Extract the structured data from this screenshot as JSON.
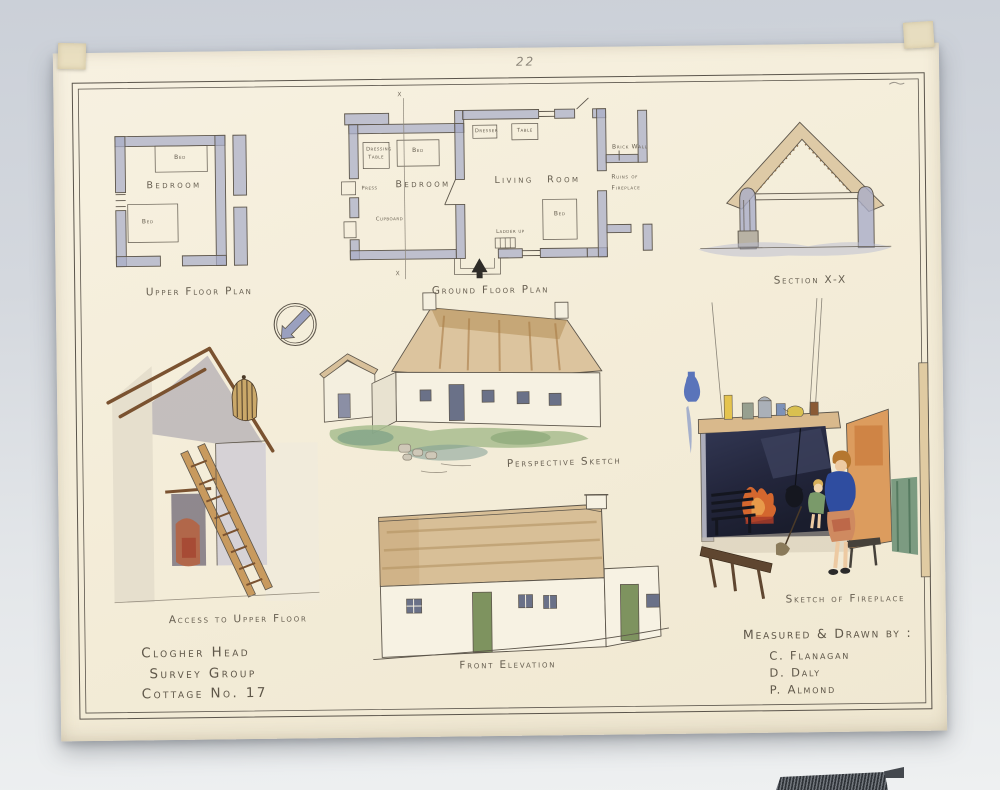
{
  "sheet": {
    "page_number": "22",
    "title_block": {
      "line1": "Clogher Head",
      "line2": "Survey Group",
      "line3": "Cottage No. 17"
    },
    "credits": {
      "heading": "Measured & Drawn by :",
      "name1": "C. Flanagan",
      "name2": "D. Daly",
      "name3": "P. Almond"
    }
  },
  "drawings": {
    "upper_floor_plan": {
      "caption": "Upper Floor Plan",
      "labels": {
        "room": "Bedroom",
        "bed_top": "Bed",
        "bed_bottom": "Bed"
      }
    },
    "ground_floor_plan": {
      "caption": "Ground Floor Plan",
      "labels": {
        "bedroom": "Bedroom",
        "living_room": "Living Room",
        "dressing_line1": "Dressing",
        "dressing_line2": "Table",
        "bed_bedroom": "Bed",
        "dresser": "Dresser",
        "table": "Table",
        "bed_living": "Bed",
        "press": "Press",
        "cupboard": "Cupboard",
        "ladder": "Ladder up",
        "brick_wall": "Brick Wall",
        "ruins_line1": "Ruins of",
        "ruins_line2": "Fireplace",
        "section_marker_top": "x",
        "section_marker_bottom": "x"
      }
    },
    "section_xx": {
      "caption": "Section X-X"
    },
    "access_upper_floor": {
      "caption": "Access to Upper Floor"
    },
    "perspective": {
      "caption": "Perspective Sketch"
    },
    "front_elevation": {
      "caption": "Front Elevation"
    },
    "fireplace": {
      "caption": "Sketch of Fireplace"
    }
  },
  "palette": {
    "background_top": "#cbd0d8",
    "background_bottom": "#eef0f1",
    "paper": "#f4eeda",
    "ink": "#5d564b",
    "pencil": "#8d867a",
    "wall_wash_blue": "#a9adc8",
    "thatch_tan": "#d9c19b",
    "grass_green": "#a8bd8f",
    "door_green": "#7e935f",
    "hearth_navy": "#262a40",
    "fire_orange": "#d4672e",
    "blouse_blue": "#2f4da0",
    "open_door_orange": "#dc9c5e",
    "ladder_wood": "#c89a5e",
    "tape": "#e8dec0"
  }
}
